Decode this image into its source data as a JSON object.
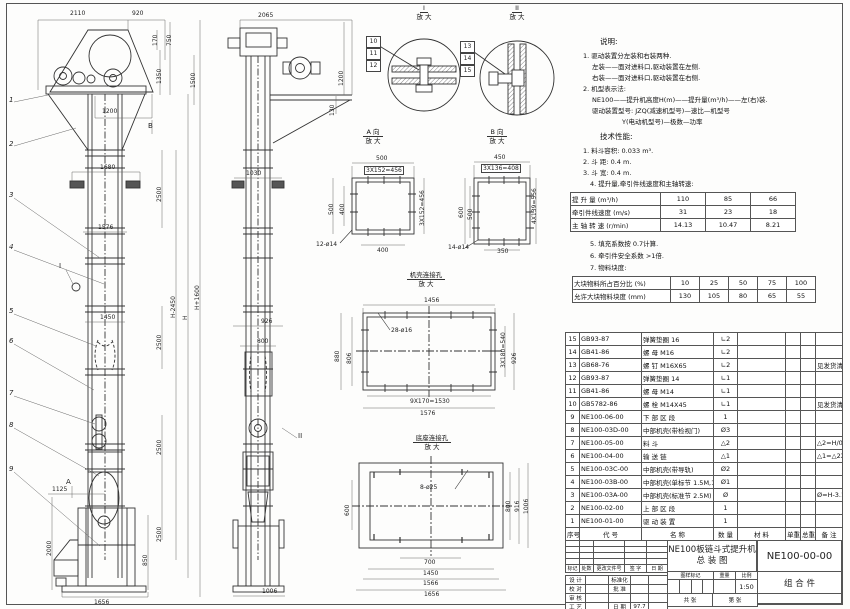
{
  "front": {
    "dims": [
      "2110",
      "920",
      "170",
      "750",
      "1350",
      "1500",
      "1200",
      "1680",
      "1576",
      "1450",
      "1125",
      "1656",
      "2500",
      "2500",
      "2500",
      "2500",
      "H-2450",
      "H",
      "H+1600",
      "2000",
      "850"
    ],
    "callouts": [
      "1",
      "2",
      "3",
      "4",
      "5",
      "6",
      "7",
      "8",
      "9"
    ],
    "markers": {
      "a": "A",
      "b": "B",
      "i": "I"
    }
  },
  "side": {
    "dims": [
      "2065",
      "1200",
      "130",
      "1030",
      "926",
      "800",
      "1006"
    ],
    "marker_ii": "II"
  },
  "detail_i": {
    "label": "I",
    "sub": "放 大",
    "callouts": [
      "10",
      "11",
      "12"
    ]
  },
  "detail_ii": {
    "label": "II",
    "sub": "放 大",
    "callouts": [
      "13",
      "14",
      "15"
    ]
  },
  "view_a": {
    "title": "A 向",
    "sub": "放 大",
    "dims": {
      "top": "500",
      "top2": "3X152=456",
      "left": "500",
      "left2": "400",
      "right": "3X152=456",
      "bottom": "400",
      "holes": "12-ø14"
    }
  },
  "view_b": {
    "title": "B 向",
    "sub": "放 大",
    "dims": {
      "top": "450",
      "top2": "3X136=408",
      "left": "600",
      "left2": "500",
      "right": "4X139=556",
      "bottom": "350",
      "holes": "14-ø14"
    }
  },
  "casing_detail": {
    "title": "机壳连接孔",
    "sub": "放 大",
    "dims": {
      "top": "1456",
      "holes": "28-ø16",
      "left": "880",
      "left2": "806",
      "right": "3X180=540",
      "right2": "926",
      "bottom": "9X170=1530",
      "bottom2": "1576"
    }
  },
  "base_detail": {
    "title": "底座连接孔",
    "sub": "放 大",
    "dims": {
      "holes": "8-ø25",
      "left": "600",
      "right1": "800",
      "right2": "916",
      "right3": "1006",
      "bottom1": "700",
      "bottom2": "1450",
      "bottom3": "1566",
      "bottom4": "1656"
    }
  },
  "notes": {
    "heading": "说明:",
    "lines": [
      "1. 驱动装置分左装和右装两种.",
      "左装——面对进料口,驱动装置在左侧.",
      "右装——面对进料口,驱动装置在右侧.",
      "2. 机型表示法:",
      "NE100——提升机高度H(m)——提升量(m³/h)——左(右)装.",
      "驱动装置型号: JZQ(减速机型号)—速比—机型号",
      "Y(电动机型号)—极数—功率"
    ]
  },
  "specs": {
    "heading": "技术性能:",
    "items_a": [
      "1. 料斗容积: 0.033 m³.",
      "2. 斗  距: 0.4 m.",
      "3. 斗  宽: 0.4 m.",
      "4. 提升量,牵引件线速度和主轴转速:"
    ],
    "items_b": [
      "5. 填充系数按 0.7计算.",
      "6. 牵引件安全系数 >1倍.",
      "7. 物料块度:"
    ]
  },
  "perf_table": {
    "rows": [
      {
        "label": "提 升 量  (m³/h)",
        "values": [
          "110",
          "85",
          "66"
        ]
      },
      {
        "label": "牵引件线速度 (m/s)",
        "values": [
          "31",
          "23",
          "18"
        ]
      },
      {
        "label": "主 轴 转 速 (r/min)",
        "values": [
          "14.13",
          "10.47",
          "8.21"
        ]
      }
    ]
  },
  "lump_table": {
    "rows": [
      {
        "label": "大块物料所占百分比 (%)",
        "values": [
          "10",
          "25",
          "50",
          "75",
          "100"
        ]
      },
      {
        "label": "允许大块物料块度 (mm)",
        "values": [
          "130",
          "105",
          "80",
          "65",
          "55"
        ]
      }
    ]
  },
  "bom": {
    "headers": [
      "序号",
      "代  号",
      "名  称",
      "数 量",
      "材  料",
      "单重",
      "总重",
      "备  注"
    ],
    "rows": [
      {
        "seq": "15",
        "code": "GB93-87",
        "name": "弹簧垫圈 16",
        "qty": "∟2",
        "remark": ""
      },
      {
        "seq": "14",
        "code": "GB41-86",
        "name": "螺  母  M16",
        "qty": "∟2",
        "remark": ""
      },
      {
        "seq": "13",
        "code": "GB68-76",
        "name": "螺  钉  M16X65",
        "qty": "∟2",
        "remark": "见发货清单"
      },
      {
        "seq": "12",
        "code": "GB93-87",
        "name": "弹簧垫圈 14",
        "qty": "∟1",
        "remark": ""
      },
      {
        "seq": "11",
        "code": "GB41-86",
        "name": "螺  母  M14",
        "qty": "∟1",
        "remark": ""
      },
      {
        "seq": "10",
        "code": "GB5782-86",
        "name": "螺  栓  M14X45",
        "qty": "∟1",
        "remark": "见发货清单"
      },
      {
        "seq": "9",
        "code": "NE100-06-00",
        "name": "下 部 区 段",
        "qty": "1",
        "remark": ""
      },
      {
        "seq": "8",
        "code": "NE100-03D-00",
        "name": "中部机壳(带检视门)",
        "qty": "Ø3",
        "remark": ""
      },
      {
        "seq": "7",
        "code": "NE100-05-00",
        "name": "料  斗",
        "qty": "△2",
        "remark": "△2=H/0.2+5.75"
      },
      {
        "seq": "6",
        "code": "NE100-04-00",
        "name": "输 送 链",
        "qty": "△1",
        "remark": "△1=△2X4"
      },
      {
        "seq": "5",
        "code": "NE100-03C-00",
        "name": "中部机壳(带导轨)",
        "qty": "Ø2",
        "remark": ""
      },
      {
        "seq": "4",
        "code": "NE100-03B-00",
        "name": "中部机壳(单标节 1.5M,1M)",
        "qty": "Ø1",
        "remark": ""
      },
      {
        "seq": "3",
        "code": "NE100-03A-00",
        "name": "中部机壳(标准节 2.5M)",
        "qty": "Ø",
        "remark": "Ø=H-3.15/2.5"
      },
      {
        "seq": "2",
        "code": "NE100-02-00",
        "name": "上 部 区 段",
        "qty": "1",
        "remark": ""
      },
      {
        "seq": "1",
        "code": "NE100-01-00",
        "name": "驱 动 装 置",
        "qty": "1",
        "remark": ""
      }
    ]
  },
  "titleblock": {
    "title_line1": "NE100板链斗式提升机",
    "title_line2": "总  装  图",
    "drawing_no": "NE100-00-00",
    "part_type": "组 合 件",
    "rev_headers": [
      "标记",
      "处数",
      "更改文件号",
      "签 字",
      "日 期"
    ],
    "sig_rows": [
      [
        "设 计",
        "",
        "标准化",
        "",
        ""
      ],
      [
        "校 对",
        "",
        "批 准",
        "",
        ""
      ],
      [
        "审 核",
        "",
        "",
        "",
        ""
      ],
      [
        "工 艺",
        "",
        "日 期",
        "97.7",
        ""
      ]
    ],
    "mark_headers": [
      "图样标记",
      "重量",
      "比例"
    ],
    "scale": "1:50",
    "sheet_total": "共  张",
    "sheet_no": "第  张"
  }
}
